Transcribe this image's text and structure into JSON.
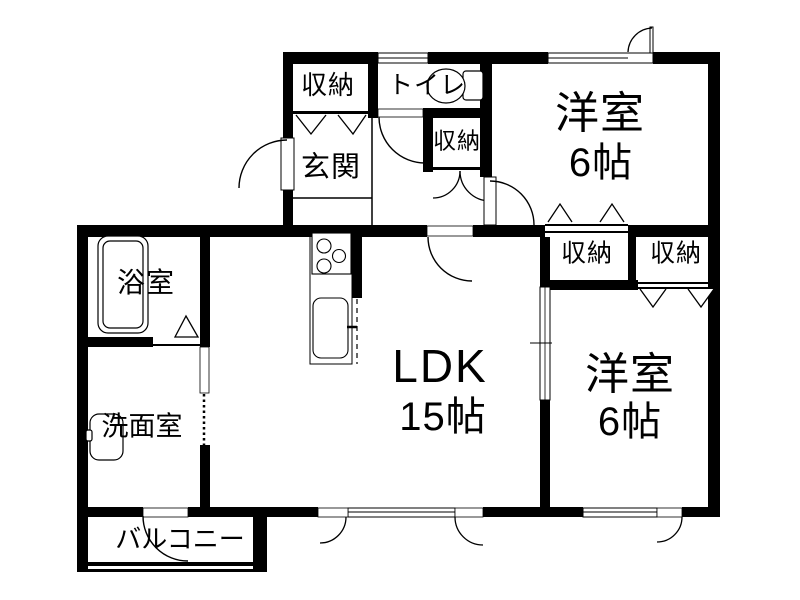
{
  "page": {
    "background_color": "#ffffff",
    "wall_color": "#000000",
    "text_color": "#000000"
  },
  "rooms": {
    "ldk": {
      "label": "LDK",
      "size": "15帖"
    },
    "bedroom_top_right": {
      "label": "洋室",
      "size": "6帖"
    },
    "bedroom_bottom_right": {
      "label": "洋室",
      "size": "6帖"
    },
    "entrance": {
      "label": "玄関"
    },
    "toilet": {
      "label": "トイレ"
    },
    "bathroom": {
      "label": "浴室"
    },
    "washroom": {
      "label": "洗面室"
    },
    "balcony": {
      "label": "バルコニー"
    },
    "closet_entrance": {
      "label": "収納"
    },
    "closet_hall": {
      "label": "収納"
    },
    "closet_top": {
      "label": "収納"
    },
    "closet_bottom": {
      "label": "収納"
    }
  },
  "icons": {
    "bathtub": "bathtub-icon",
    "toilet_bowl": "toilet-icon",
    "washbasin": "washbasin-icon",
    "stove": "stove-icon",
    "kitchen_sink": "kitchen-sink-icon"
  }
}
